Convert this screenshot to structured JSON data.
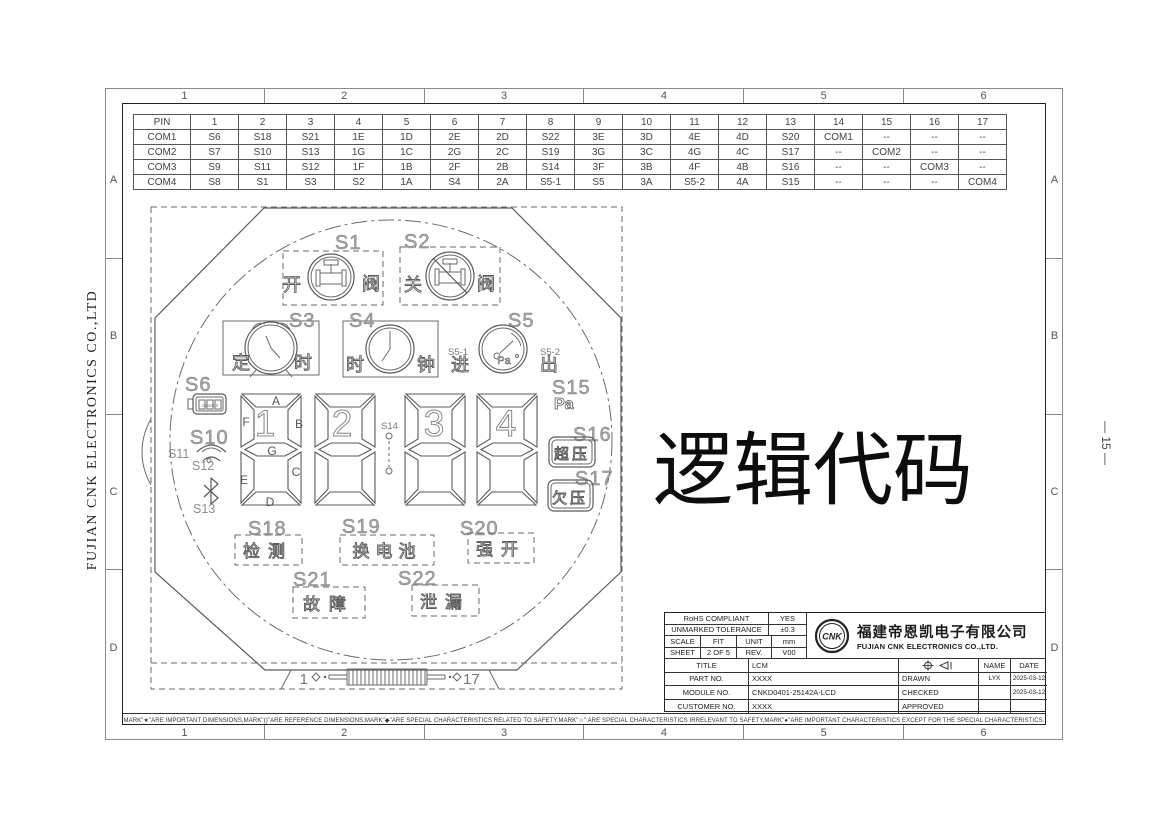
{
  "page": {
    "big_text": "逻辑代码",
    "side_text_left": "FUJIAN CNK ELECTRONICS CO.,LTD",
    "side_text_right": "— 15 —",
    "footnote": "MARK\"★\"ARE IMPORTANT DIMENSIONS,MARK\"()\"ARE REFERENCE DIMENSIONS,MARK\"◆\"ARE SPECIAL CHARACTERISTICS RELATED TO SAFETY,MARK\"☆\" ARE SPECIAL CHARACTERISTICS IRRELEVANT TO SAFETY,MARK\"●\"ARE IMPORTANT CHARACTERISTICS EXCEPT FOR THE SPECIAL CHARACTERISTICS."
  },
  "border": {
    "cols": [
      "1",
      "2",
      "3",
      "4",
      "5",
      "6"
    ],
    "rows": [
      "A",
      "B",
      "C",
      "D"
    ]
  },
  "pin_table": {
    "header": [
      "PIN",
      "1",
      "2",
      "3",
      "4",
      "5",
      "6",
      "7",
      "8",
      "9",
      "10",
      "11",
      "12",
      "13",
      "14",
      "15",
      "16",
      "17"
    ],
    "rows": [
      {
        "label": "COM1",
        "cells": [
          "S6",
          "S18",
          "S21",
          "1E",
          "1D",
          "2E",
          "2D",
          "S22",
          "3E",
          "3D",
          "4E",
          "4D",
          "S20",
          "COM1",
          "--",
          "--",
          "--"
        ]
      },
      {
        "label": "COM2",
        "cells": [
          "S7",
          "S10",
          "S13",
          "1G",
          "1C",
          "2G",
          "2C",
          "S19",
          "3G",
          "3C",
          "4G",
          "4C",
          "S17",
          "--",
          "COM2",
          "--",
          "--"
        ]
      },
      {
        "label": "COM3",
        "cells": [
          "S9",
          "S11",
          "S12",
          "1F",
          "1B",
          "2F",
          "2B",
          "S14",
          "3F",
          "3B",
          "4F",
          "4B",
          "S16",
          "--",
          "--",
          "COM3",
          "--"
        ]
      },
      {
        "label": "COM4",
        "cells": [
          "S8",
          "S1",
          "S3",
          "S2",
          "1A",
          "S4",
          "2A",
          "S5-1",
          "S5",
          "3A",
          "S5-2",
          "4A",
          "S15",
          "--",
          "--",
          "--",
          "COM4"
        ]
      }
    ]
  },
  "lcd": {
    "segments": {
      "s1": {
        "label": "S1",
        "text_left": "开",
        "text_right": "阀"
      },
      "s2": {
        "label": "S2",
        "text_left": "关",
        "text_right": "阀"
      },
      "s3": {
        "label": "S3",
        "text_left": "定",
        "text_right": "时"
      },
      "s4": {
        "label": "S4",
        "text_left": "时",
        "text_right": "钟"
      },
      "s5": {
        "label": "S5",
        "sub_left_label": "S5-1",
        "sub_right_label": "S5-2",
        "text_left": "进",
        "text_right": "出",
        "gauge_unit": "Pa"
      },
      "s6": {
        "label": "S6",
        "bars_label": "S7S8S9"
      },
      "s10": {
        "label": "S10"
      },
      "s11": {
        "label": "S11"
      },
      "s12": {
        "label": "S12"
      },
      "s13": {
        "label": "S13"
      },
      "s14": {
        "label": "S14"
      },
      "s15": {
        "label": "S15",
        "text": "Pa"
      },
      "s16": {
        "label": "S16",
        "text": "超压"
      },
      "s17": {
        "label": "S17",
        "text": "欠压"
      },
      "s18": {
        "label": "S18",
        "text": "检测"
      },
      "s19": {
        "label": "S19",
        "text": "换电池"
      },
      "s20": {
        "label": "S20",
        "text": "强开"
      },
      "s21": {
        "label": "S21",
        "text": "故障"
      },
      "s22": {
        "label": "S22",
        "text": "泄漏"
      }
    },
    "digits": {
      "labels": [
        "1",
        "2",
        "3",
        "4"
      ],
      "segment_letters": [
        "A",
        "B",
        "C",
        "D",
        "E",
        "F",
        "G"
      ]
    },
    "connector": {
      "left_pin": "1",
      "right_pin": "17"
    }
  },
  "title_block": {
    "rohs_label": "RoHS COMPLIANT",
    "rohs_value": "YES",
    "tolerance_label": "UNMARKED TOLERANCE",
    "tolerance_value": "±0.3",
    "scale_label": "SCALE",
    "scale_value": "FIT",
    "unit_label": "UNIT",
    "unit_value": "mm",
    "sheet_label": "SHEET",
    "sheet_value": "2 OF 5",
    "rev_label": "REV.",
    "rev_value": "V00",
    "logo_text": "CNK",
    "company_cn": "福建帝恩凯电子有限公司",
    "company_en": "FUJIAN CNK ELECTRONICS CO.,LTD.",
    "title_label": "TITLE",
    "title_value": "LCM",
    "name_label": "NAME",
    "date_label": "DATE",
    "part_label": "PART NO.",
    "part_value": "XXXX",
    "module_label": "MODULE NO.",
    "module_value": "CNKD0401-25142A-LCD",
    "customer_label": "CUSTOMER NO.",
    "customer_value": "XXXX",
    "drawn_label": "DRAWN",
    "drawn_name": "LYX",
    "drawn_date": "2025-03-12",
    "checked_label": "CHECKED",
    "checked_name": "",
    "checked_date": "2025-03-12",
    "approved_label": "APPROVED",
    "approved_name": "",
    "approved_date": ""
  }
}
